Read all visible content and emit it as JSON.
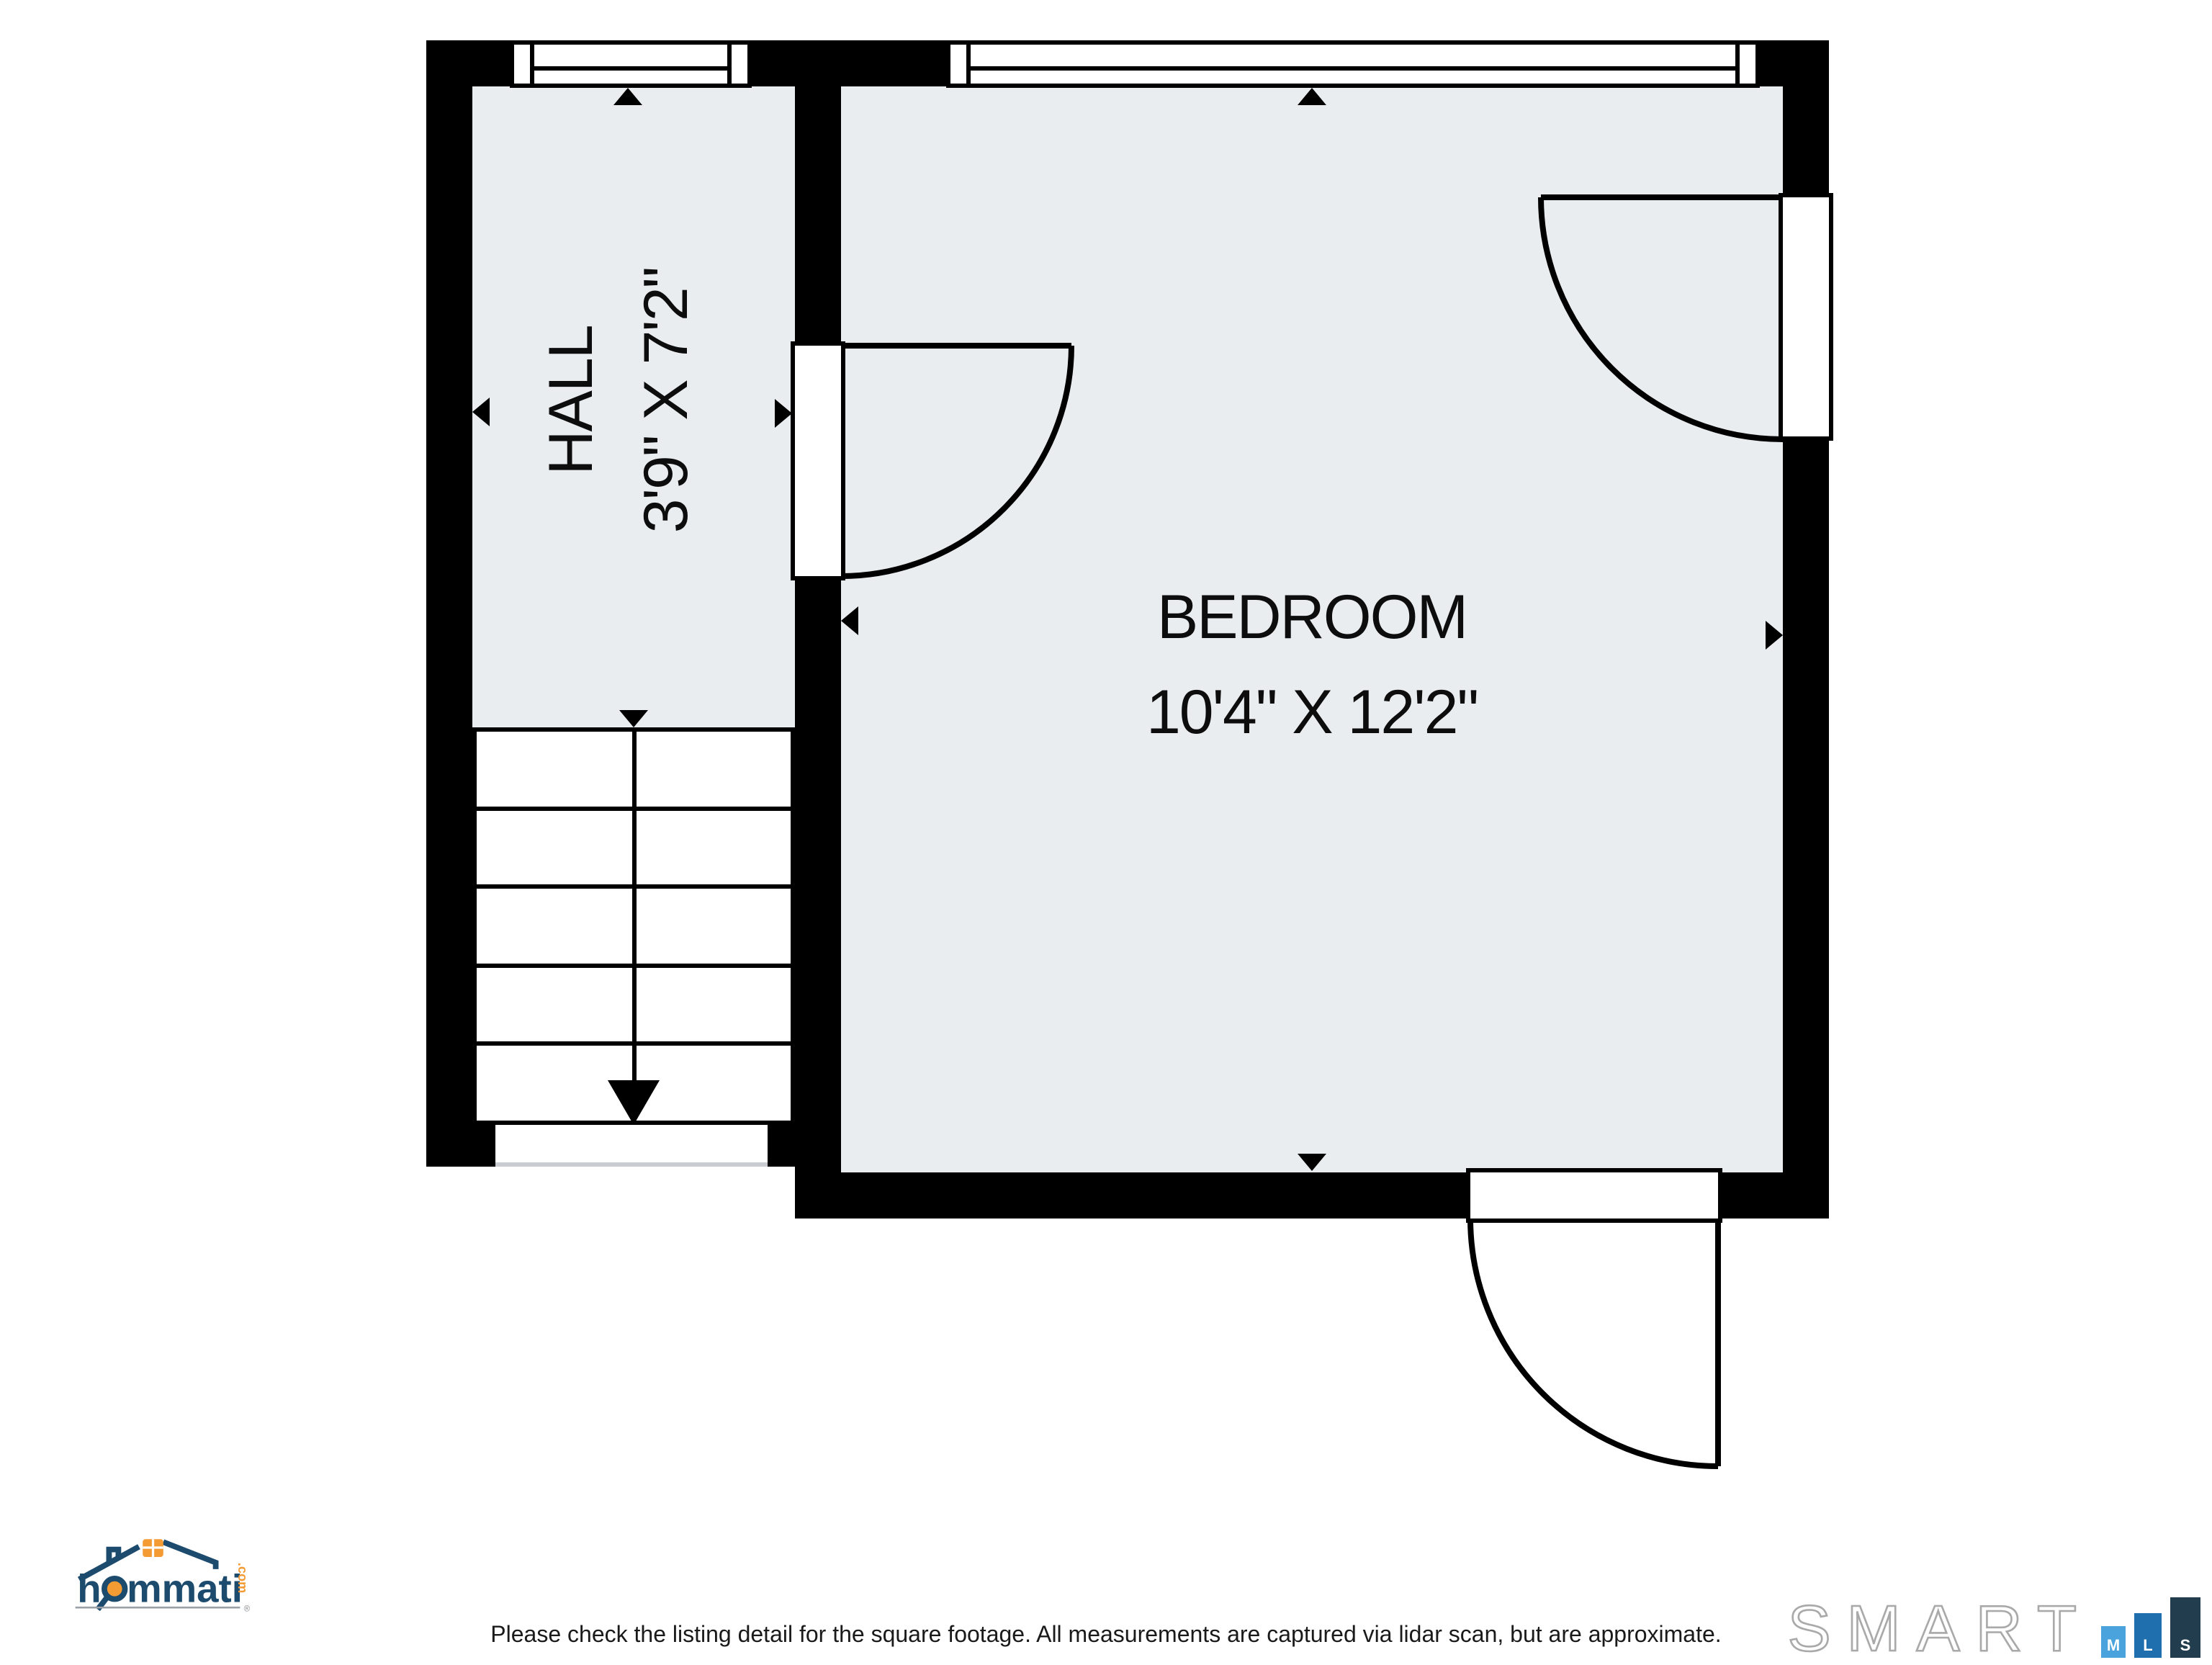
{
  "plan": {
    "rooms": [
      {
        "id": "hall",
        "label": "HALL",
        "dimensions": "3'9\" X 7'2\""
      },
      {
        "id": "bedroom",
        "label": "BEDROOM",
        "dimensions": "10'4\" X 12'2\""
      }
    ],
    "fill_color": "#e9edf0",
    "wall_color": "#000000"
  },
  "footer": {
    "disclaimer": "Please check the listing detail for the square footage. All measurements are captured via lidar scan, but are approximate."
  },
  "branding": {
    "hommati": {
      "name_start": "h",
      "name_end": "mmati",
      "tld": ".com",
      "registered": "®",
      "navy": "#1d4b6e",
      "orange": "#f49b33"
    },
    "smartmls": {
      "wordmark": "SMART",
      "bars": [
        {
          "letter": "M",
          "color": "#4aa3dc"
        },
        {
          "letter": "L",
          "color": "#1f6fae"
        },
        {
          "letter": "S",
          "color": "#223d4e"
        }
      ]
    }
  }
}
